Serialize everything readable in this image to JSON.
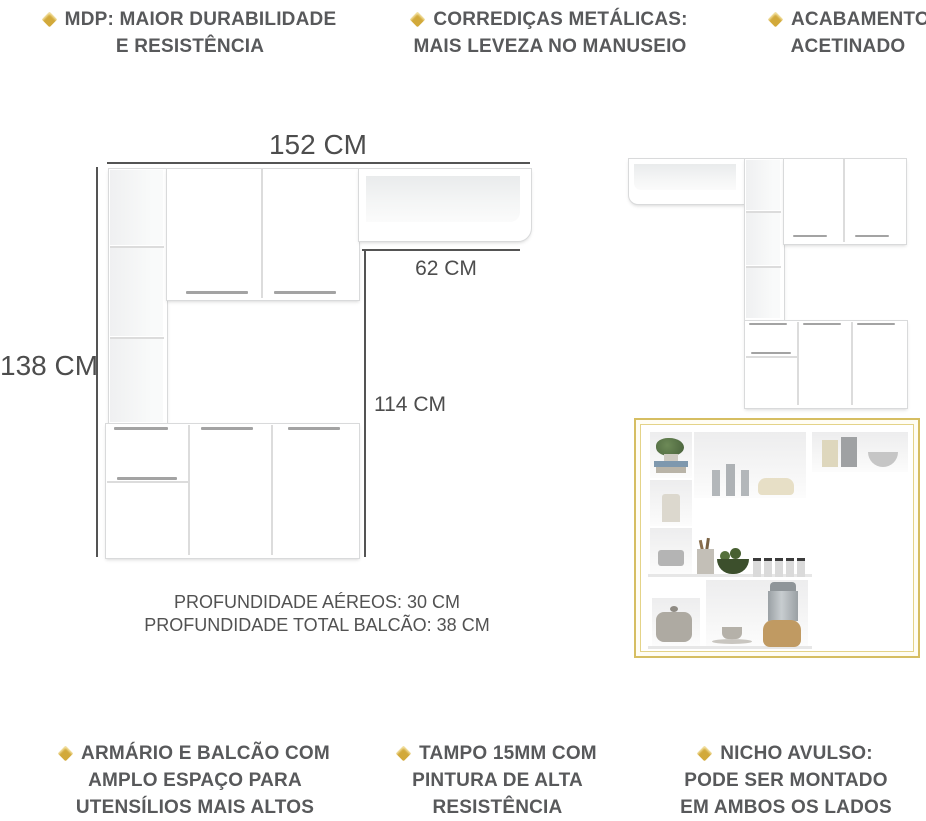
{
  "features_top": [
    {
      "line1": "MDP: MAIOR DURABILIDADE",
      "line2": "E RESISTÊNCIA"
    },
    {
      "line1": "CORREDIÇAS METÁLICAS:",
      "line2": "MAIS LEVEZA NO MANUSEIO"
    },
    {
      "line1": "ACABAMENTO",
      "line2": "ACETINADO"
    }
  ],
  "features_bottom": [
    {
      "line1": "ARMÁRIO E BALCÃO COM",
      "line2": "AMPLO ESPAÇO PARA",
      "line3": "UTENSÍLIOS MAIS ALTOS"
    },
    {
      "line1": "TAMPO 15MM COM",
      "line2": "PINTURA DE ALTA",
      "line3": "RESISTÊNCIA"
    },
    {
      "line1": "NICHO AVULSO:",
      "line2": "PODE SER MONTADO",
      "line3": "EM AMBOS OS LADOS"
    }
  ],
  "dimensions": {
    "total_width": "152 CM",
    "total_height": "138 CM",
    "shelf_width": "62 CM",
    "counter_height": "114 CM",
    "depth_aereos": "PROFUNDIDADE AÉREOS: 30 CM",
    "depth_balcao": "PROFUNDIDADE TOTAL BALCÃO: 38 CM"
  },
  "colors": {
    "accent_gold": "#d2a93a",
    "frame_gold": "#d6be62",
    "text_gray": "#58595b",
    "dimension_gray": "#4d4d4d"
  },
  "photo": {
    "props": [
      "plant-on-books",
      "candle",
      "trivet",
      "silver-candles",
      "round-box",
      "canisters",
      "bowl",
      "utensil-cup",
      "fruit-bowl",
      "spice-jars",
      "teapot",
      "cup-and-saucer",
      "blender"
    ]
  }
}
